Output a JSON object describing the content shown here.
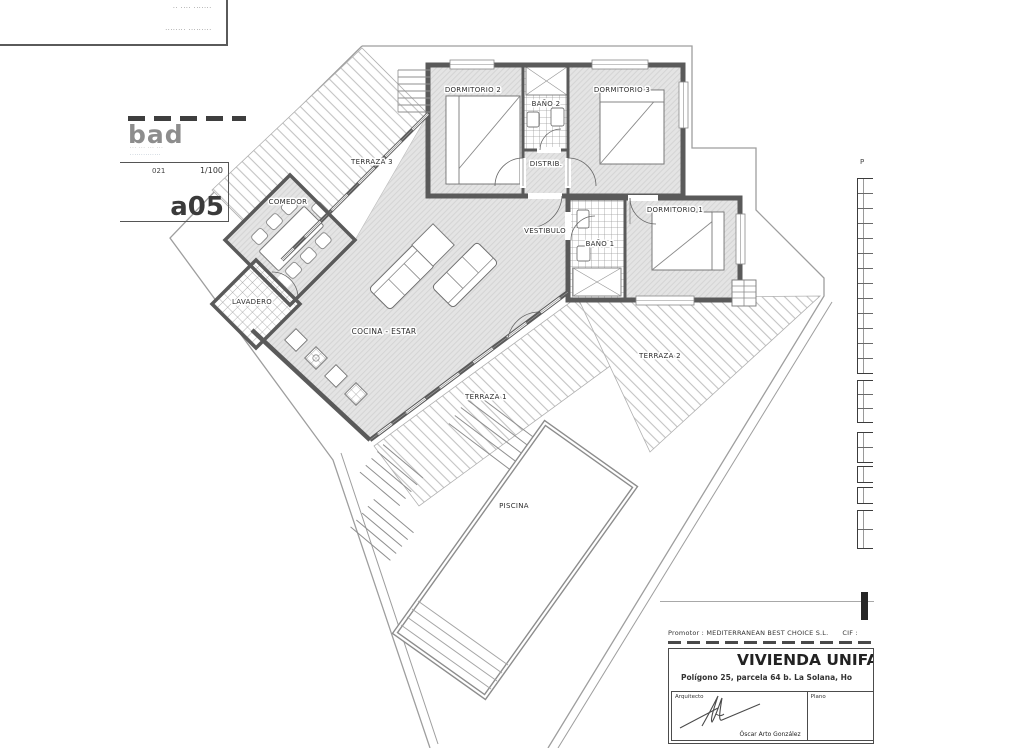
{
  "note_box": {
    "line1": "·· ···· ·······",
    "line2": "········ ·········"
  },
  "stamp": {
    "logo": "bad",
    "contact_line1": "··· ··· ··· ···",
    "contact_line2": "··············",
    "code": "021",
    "scale": "1/100",
    "sheet": "a05"
  },
  "plan": {
    "rooms": [
      {
        "label": "TERRAZA 3"
      },
      {
        "label": "DORMITORIO 2"
      },
      {
        "label": "BAÑO 2"
      },
      {
        "label": "DORMITORIO 3"
      },
      {
        "label": "DISTRIB."
      },
      {
        "label": "COMEDOR"
      },
      {
        "label": "VESTIBULO"
      },
      {
        "label": "BAÑO 1"
      },
      {
        "label": "DORMITORIO 1"
      },
      {
        "label": "LAVADERO"
      },
      {
        "label": "COCINA - ESTAR"
      },
      {
        "label": "TERRAZA 2"
      },
      {
        "label": "TERRAZA 1"
      },
      {
        "label": "PISCINA"
      }
    ]
  },
  "side_panel": {
    "header_fragment": "P"
  },
  "title_block": {
    "promotor": "Promotor : MEDITERRANEAN BEST CHOICE S.L.",
    "cif": "CIF :",
    "title": "VIVIENDA UNIFAMI",
    "address": "Polígono 25, parcela 64 b. La Solana, Ho",
    "architect_label": "Arquitecto",
    "architect_name": "Óscar Arto González",
    "plano_label": "Plano"
  }
}
